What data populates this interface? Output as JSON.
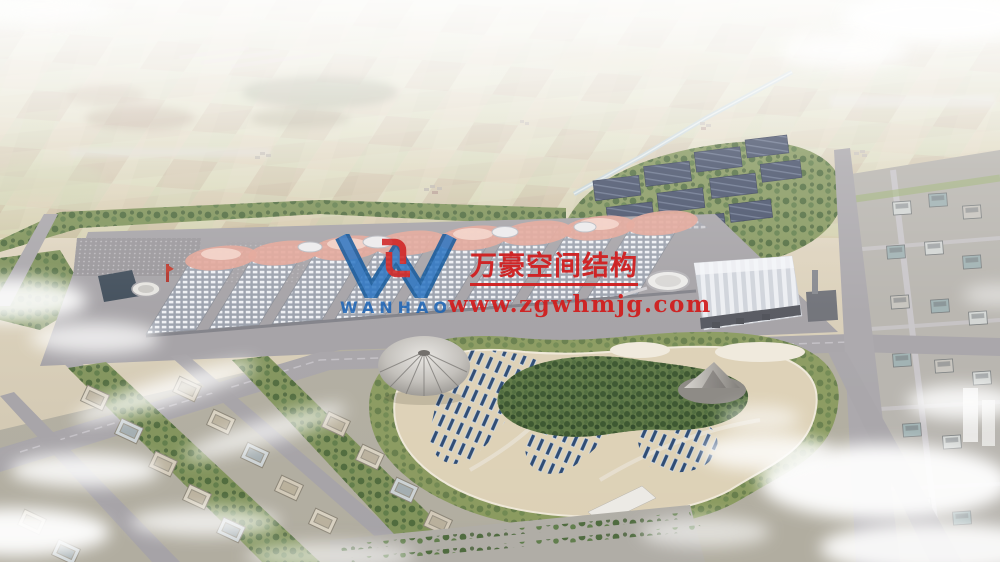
{
  "watermark": {
    "brand_cn": "万豪空间结构",
    "website": "www.zgwhmjg.com",
    "logo_text": "WANHAO",
    "logo_letter": "W",
    "brand_red": "#d11c1c",
    "logo_blue": "#1a63b5",
    "logo_red": "#cf1f1f"
  },
  "scene": {
    "type": "aerial architectural rendering",
    "subject": "exhibition-center campus: wave-roof halls, pleated-roof station, solar farm, central park with dome and cone pavilions, residential blocks, hazy farmland horizon"
  }
}
